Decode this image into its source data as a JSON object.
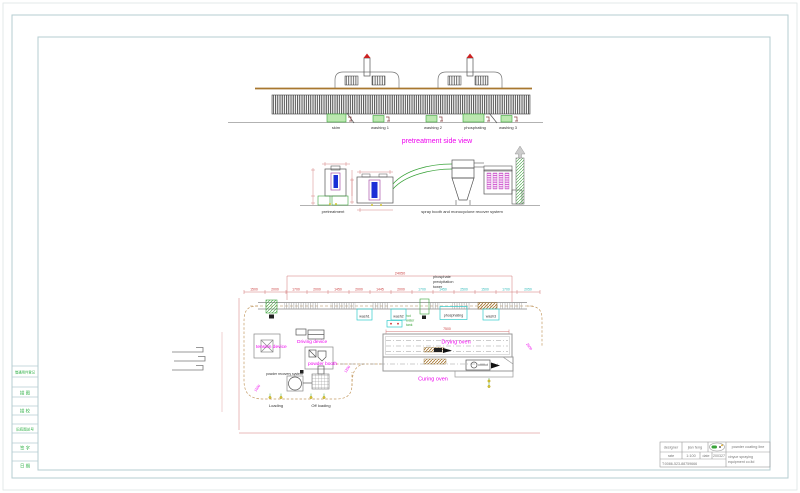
{
  "colors": {
    "accent_magenta": "#ee00ee",
    "dim_red": "#cc3333",
    "tank_green": "#3aa33a",
    "cyan_line": "#33cccc",
    "conveyor_brown": "#a8772f",
    "frame_text_green": "#33b24a"
  },
  "frame": {
    "left_strip_cells": [
      "借通用件登记",
      "描 图",
      "描 校",
      "旧底图总号",
      "签 字",
      "日 期"
    ]
  },
  "side_view": {
    "title": "pretreatment side view",
    "tank_labels": [
      "skim",
      "washing 1",
      "washing 2",
      "phosphating",
      "washing 3"
    ]
  },
  "elevations": {
    "pretreatment_label": "pretreatment",
    "spray_label": "spray booth and monocyclone recover system"
  },
  "plan": {
    "labels": {
      "tension_device": "tension device",
      "driving_device": "Driving device",
      "powder_booth": "powder booth",
      "powder_recovery": "powder recovery system",
      "drying_oven": "Drying oven",
      "curing_oven": "Curing oven",
      "loading": "Loading",
      "off_loading": "Off loading",
      "phosphate_tower_1": "phosphate",
      "phosphate_tower_2": "precipitation",
      "phosphate_tower_3": "tower",
      "hot_water_1": "hot",
      "hot_water_2": "water",
      "hot_water_3": "tank"
    },
    "tank_labels": [
      "wash1",
      "wash2",
      "phosphating",
      "wash3"
    ],
    "dim_total": "24050",
    "oven_dim": "7500",
    "dims_top": [
      "1500",
      "2000",
      "1700",
      "2000",
      "1450",
      "2000",
      "1445",
      "2000",
      "1700",
      "1450",
      "2500",
      "1500",
      "1700",
      "2050"
    ],
    "dims_rotated": [
      "1500",
      "1200",
      "2500"
    ]
  },
  "title_block": {
    "designer_label": "designer",
    "designer_name": "jian feng",
    "rate_label": "rate",
    "rate_value": "1:100",
    "date_label": "date",
    "date_value": "200327",
    "phone": "T:0086-523-88759666",
    "product": "powder coating line",
    "company_1": "xinyue spraying",
    "company_2": "equipment co.ltd"
  }
}
